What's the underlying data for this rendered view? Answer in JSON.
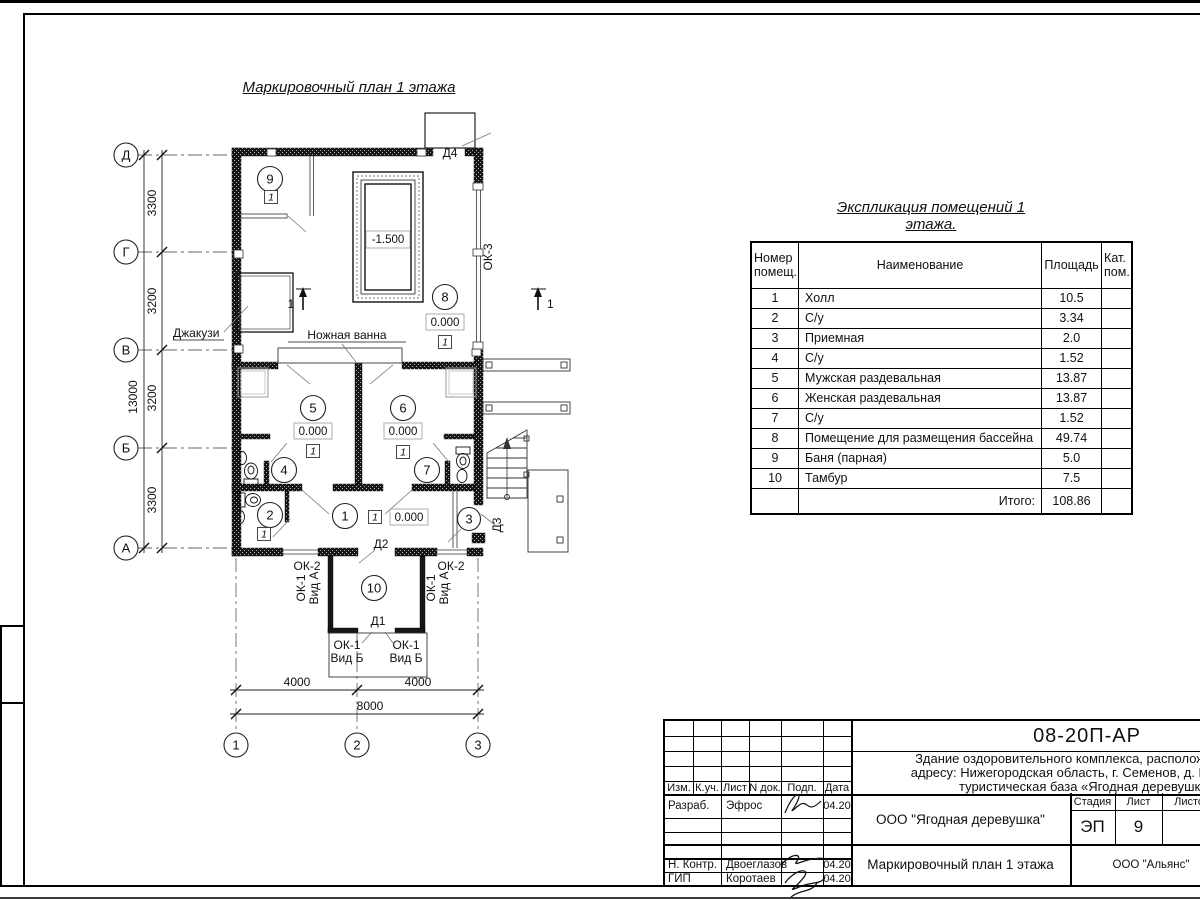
{
  "plan": {
    "title": "Маркировочный план 1 этажа",
    "axes_rows": [
      "Д",
      "Г",
      "В",
      "Б",
      "А"
    ],
    "axes_cols": [
      "1",
      "2",
      "3"
    ],
    "dims_v": [
      "3300",
      "3200",
      "3200",
      "3300"
    ],
    "dim_v_total": "13000",
    "dims_h": [
      "4000",
      "4000"
    ],
    "dim_h_total": "8000",
    "section_mark": "1",
    "room_numbers": [
      "1",
      "2",
      "3",
      "4",
      "5",
      "6",
      "7",
      "8",
      "9",
      "10"
    ],
    "labels": {
      "jacuzzi": "Джакузи",
      "foot_bath": "Ножная ванна",
      "pool_level": "-1.500",
      "zero_level": "0.000",
      "floor_type": "1",
      "d1": "Д1",
      "d2": "Д2",
      "d3": "Д3",
      "d4": "Д4",
      "ok1": "ОК-1",
      "vid_a": "Вид А",
      "vid_b": "Вид Б",
      "ok2": "ОК-2",
      "ok3": "ОК-3"
    }
  },
  "explication": {
    "title": "Экспликация помещений 1 этажа.",
    "headers": {
      "num1": "Номер",
      "num2": "помещ.",
      "name": "Наименование",
      "area": "Площадь",
      "cat1": "Кат.",
      "cat2": "пом."
    },
    "rows": [
      {
        "num": "1",
        "name": "Холл",
        "area": "10.5"
      },
      {
        "num": "2",
        "name": "С/у",
        "area": "3.34"
      },
      {
        "num": "3",
        "name": "Приемная",
        "area": "2.0"
      },
      {
        "num": "4",
        "name": "С/у",
        "area": "1.52"
      },
      {
        "num": "5",
        "name": "Мужская раздевальная",
        "area": "13.87"
      },
      {
        "num": "6",
        "name": "Женская раздевальная",
        "area": "13.87"
      },
      {
        "num": "7",
        "name": "С/у",
        "area": "1.52"
      },
      {
        "num": "8",
        "name": "Помещение для размещения бассейна",
        "area": "49.74"
      },
      {
        "num": "9",
        "name": "Баня (парная)",
        "area": "5.0"
      },
      {
        "num": "10",
        "name": "Тамбур",
        "area": "7.5"
      }
    ],
    "total_label": "Итого:",
    "total_value": "108.86"
  },
  "titleblock": {
    "doc_number": "08-20П-АР",
    "address_line1": "Здание оздоровительного комплекса, расположенное по",
    "address_line2": "адресу: Нижегородская область, г. Семенов, д. Мериново,",
    "address_line3": "туристическая база «Ягодная деревушка»",
    "col_izm": "Изм.",
    "col_kuch": "К.уч.",
    "col_list": "Лист",
    "col_ndok": "N док.",
    "col_podp": "Подп.",
    "col_data": "Дата",
    "staff": [
      {
        "role": "Разраб.",
        "name": "Эфрос",
        "date": "04.20"
      },
      {
        "role": "Н. Контр.",
        "name": "Двоеглазов",
        "date": "04.20"
      },
      {
        "role": "ГИП",
        "name": "Коротаев",
        "date": "04.20"
      }
    ],
    "company": "ООО \"Ягодная деревушка\"",
    "stage_label": "Стадия",
    "sheet_label": "Лист",
    "sheets_label": "Листов",
    "stage": "ЭП",
    "sheet_num": "9",
    "doc_title": "Маркировочный план 1 этажа",
    "org": "ООО \"Альянс\""
  }
}
